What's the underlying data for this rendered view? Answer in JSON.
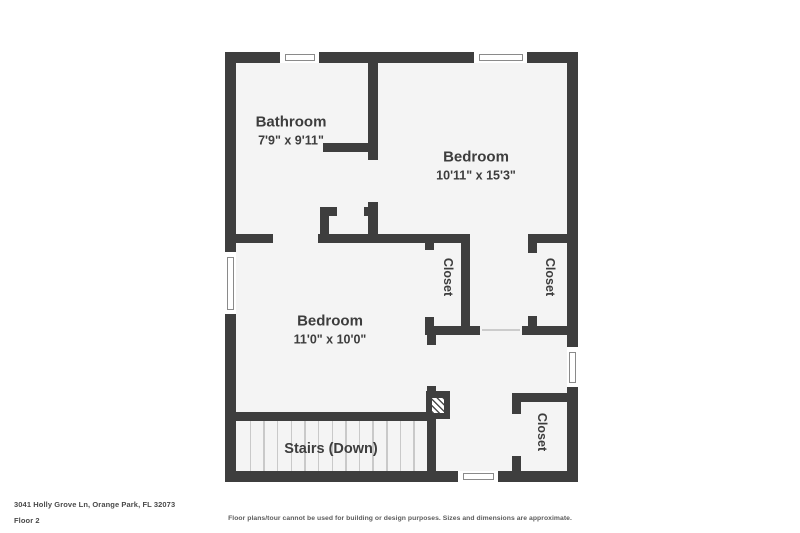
{
  "rooms": {
    "bathroom": {
      "label": "Bathroom",
      "dims": "7'9\" x 9'11\""
    },
    "bedroom_top": {
      "label": "Bedroom",
      "dims": "10'11\" x 15'3\""
    },
    "bedroom_left": {
      "label": "Bedroom",
      "dims": "11'0\" x 10'0\""
    },
    "closet_left": {
      "label": "Closet"
    },
    "closet_hall": {
      "label": "Closet"
    },
    "closet_bottom": {
      "label": "Closet"
    }
  },
  "stairs": {
    "label": "Stairs (Down)",
    "tread_count": 13
  },
  "footer": {
    "address": "3041 Holly Grove Ln, Orange Park, FL 32073",
    "floor": "Floor 2",
    "disclaimer": "Floor plans/tour cannot be used for building or design purposes. Sizes and dimensions are approximate."
  },
  "colors": {
    "wall": "#3e3e3e",
    "floor": "#f4f4f4",
    "text": "#3d3d3d"
  }
}
